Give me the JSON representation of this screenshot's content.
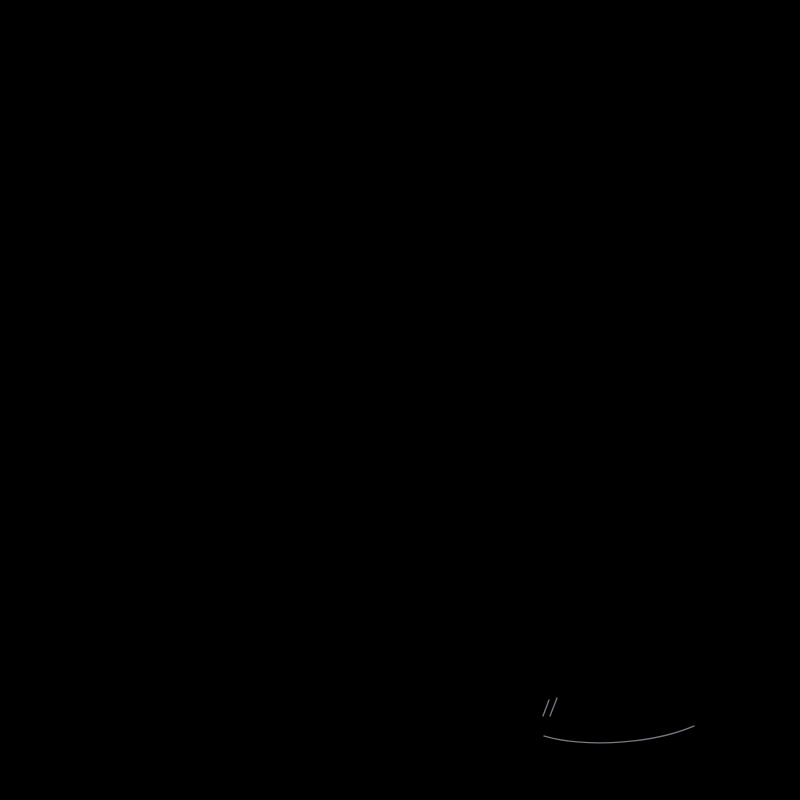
{
  "artwork": {
    "signature": "John Powell"
  },
  "colors": {
    "paper": "#f1f0ed",
    "foliageDark": "#24421f",
    "foliageMid": "#38652a",
    "lattice": "#a5834f",
    "latticeHi": "#bf9f68",
    "braidMid": "#c49a52",
    "braidHi": "#e4c583",
    "braidDark": "#7c5a28",
    "braidEdge": "#58401c",
    "teal": "#2a7a8c",
    "tealHi": "#4fa6b6",
    "tealDark": "#17505e",
    "tealDeep": "#0d3842",
    "cushion": "#b26c4c",
    "cushionLight": "#c9865f",
    "cushionDark": "#8e5037",
    "cushionEdge": "#7c4630",
    "cushionTopHi": "#d69a74",
    "ribbon": "#c6d6dd",
    "ribbonMid": "#a9bfc9",
    "ribbonShadow": "#74909f",
    "yellow": "#f2c736",
    "yellowDeep": "#d4a01c",
    "twig": "#3a2113",
    "sprigLeaf": "#4fae35",
    "mint": "#aeeadf",
    "mintLight": "#e2fbf4",
    "mintStripe": "#79cfc2",
    "mintDeep": "#56b3a6",
    "clothOutline": "#b08cc8",
    "clothSwirl": "#a678c8",
    "clothPetal": "#eadcc6",
    "clothBud": "#cdb0dc",
    "budEdge": "#9a74b8",
    "sage": "#87a090",
    "sageLight": "#9db5a4",
    "sageDark": "#4d6f5c",
    "sageDeep": "#3d5f4e",
    "vine": "#a06f92",
    "piping": "#b088a0",
    "roseCream": "#e8d7a4",
    "roseEdge": "#bf9a50",
    "roseCenter": "#d8b86a",
    "roseBrown": "#8a6a3a",
    "daisyCenter": "#66503a",
    "pinkFlower": "#dc9ec0",
    "branchDark": "#44304a",
    "grey": "#a8a7a4",
    "greyLight": "#c6c4c0",
    "greyDark": "#6f6e6b",
    "stemGreen": "#2e5a26",
    "vein": "#8cc06a",
    "leafBright": "#6fae52",
    "white": "#f2f0e8",
    "signature": "#8e8f93",
    "underline": "#9a9ba0",
    "greens": [
      "#2c4f22",
      "#38652a",
      "#456f2e",
      "#51843a",
      "#5f9a42",
      "#6b9a50"
    ],
    "leafDarks": [
      "#2d5a24",
      "#356b2a",
      "#3f7c2f",
      "#2e5c38"
    ],
    "wis": [
      "#9187d8",
      "#a29ae2",
      "#8278d0",
      "#b4ace8",
      "#c6c0f0",
      "#746ac4"
    ],
    "centers": [
      "#ffffff",
      "#f0e494"
    ],
    "hyd": {
      "mid": [
        "#8a6cc9",
        "#9b7fd6",
        "#7a5cbe",
        "#b091e2",
        "#6d4fb2",
        "#c7a4ec"
      ],
      "warm": [
        "#9b6fd0",
        "#b483dc",
        "#c06ac4",
        "#d27fc9",
        "#8a5cc0",
        "#c795e6",
        "#b18ade"
      ],
      "blue": [
        "#8d85d6",
        "#a29ae2",
        "#b9b1ec",
        "#7d74cc",
        "#9a90dc",
        "#cdc7f2"
      ]
    },
    "hydBase": {
      "mid": "#5d47a0",
      "warm": "#6a4a9e",
      "blue": "#6a62b8"
    }
  }
}
